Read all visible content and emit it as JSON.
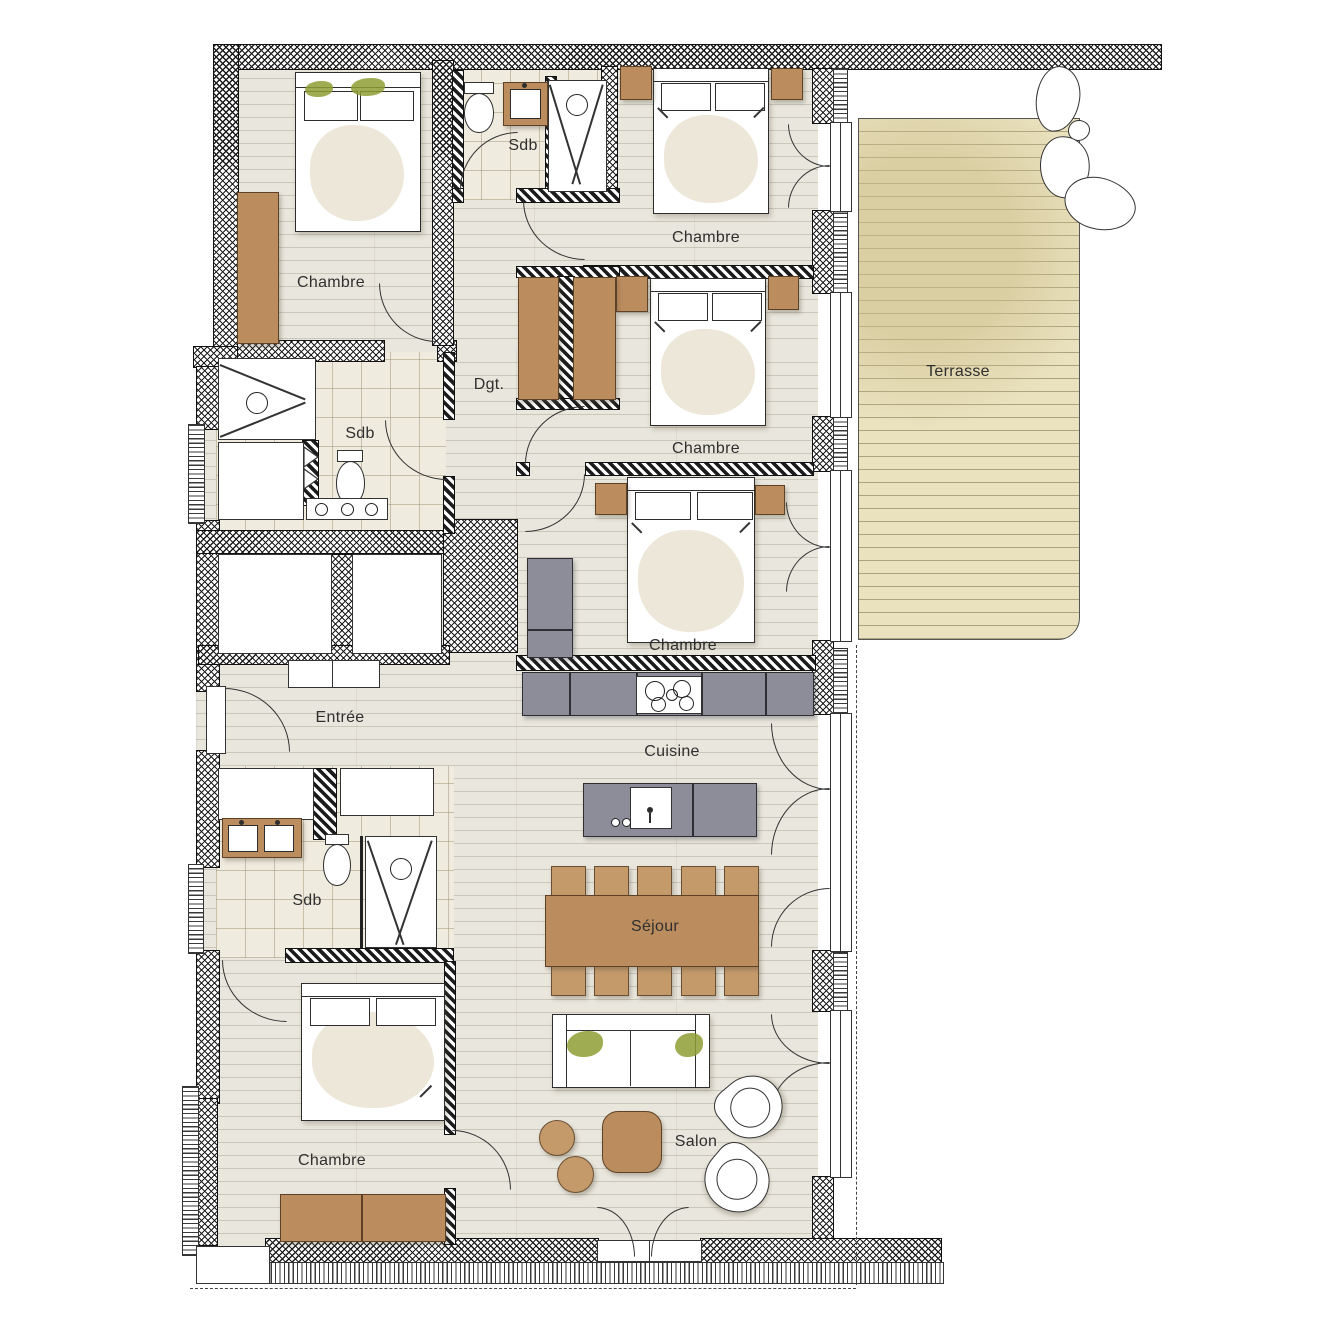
{
  "plan_labels": {
    "chambre_nw": "Chambre",
    "sdb_n": "Sdb",
    "chambre_n": "Chambre",
    "chambre_e": "Chambre",
    "dgt": "Dgt.",
    "sdb_w": "Sdb",
    "terrasse": "Terrasse",
    "chambre_se": "Chambre",
    "entree": "Entrée",
    "cuisine": "Cuisine",
    "sdb_sw": "Sdb",
    "sejour": "Séjour",
    "chambre_sw": "Chambre",
    "salon": "Salon"
  },
  "colors": {
    "wood_floor": "#e9e6dd",
    "tile_floor": "#f0ebdf",
    "terrace_deck": "#eae2bf",
    "furniture_brown": "#bb8c5d",
    "counter_gray": "#8d8d99",
    "plant_green": "#8f9e33",
    "line": "#2d2d2d"
  }
}
